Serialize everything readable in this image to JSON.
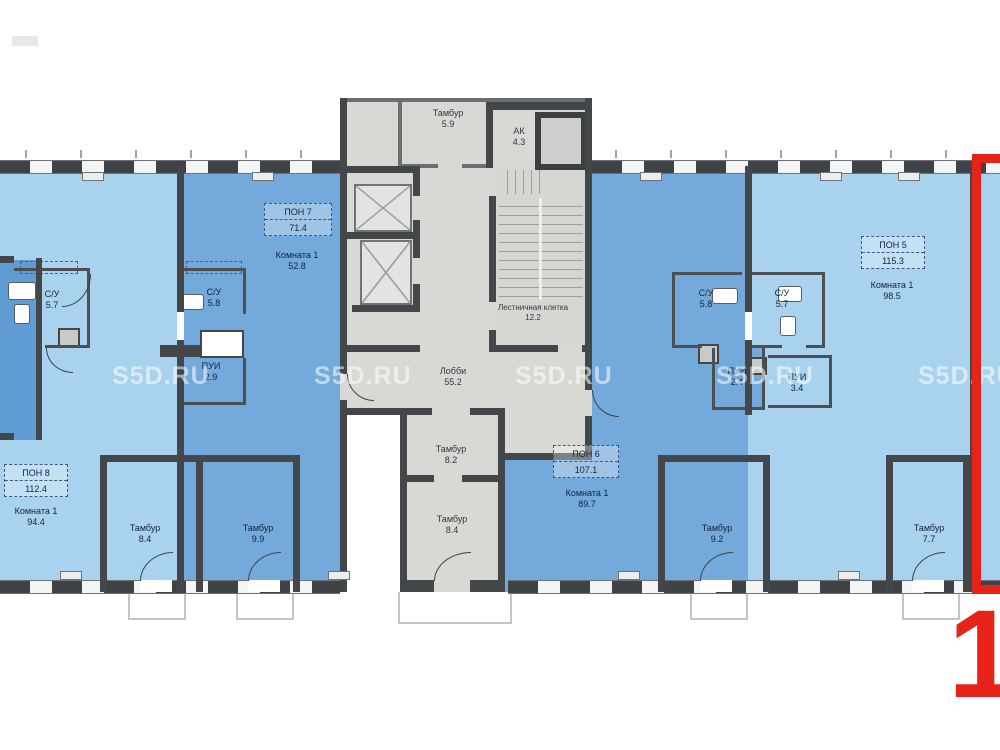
{
  "watermark": {
    "text": "S5D.RU"
  },
  "highlight": {
    "label": "1",
    "color": "#e62219"
  },
  "colors": {
    "room_light_blue": "#a9d2ee",
    "room_dark_blue": "#74a9db",
    "common_grey": "#d8d8d5",
    "wall": "#43474a",
    "highlight_red": "#e62219"
  },
  "units": {
    "pon8": {
      "name": "ПОН 8",
      "area": "112.4",
      "room_name": "Комната 1",
      "room_area": "94.4"
    },
    "pon7": {
      "name": "ПОН 7",
      "area": "71.4",
      "room_name": "Комната 1",
      "room_area": "52.8"
    },
    "pon6": {
      "name": "ПОН 6",
      "area": "107.1",
      "room_name": "Комната 1",
      "room_area": "89.7"
    },
    "pon5": {
      "name": "ПОН 5",
      "area": "115.3",
      "room_name": "Комната 1",
      "room_area": "98.5"
    }
  },
  "rooms": {
    "tambur_top": {
      "name": "Тамбур",
      "area": "5.9"
    },
    "ak": {
      "name": "АК",
      "area": "4.3"
    },
    "stair": {
      "name": "Лестничная клетка",
      "area": "12.2"
    },
    "lobby": {
      "name": "Лобби",
      "area": "55.2"
    },
    "tambur_82": {
      "name": "Тамбур",
      "area": "8.2"
    },
    "tambur_84c": {
      "name": "Тамбур",
      "area": "8.4"
    },
    "su57_left": {
      "name": "С/У",
      "area": "5.7"
    },
    "su58_left": {
      "name": "С/У",
      "area": "5.8"
    },
    "pui29": {
      "name": "ПУИ",
      "area": "2.9"
    },
    "tambur_84l": {
      "name": "Тамбур",
      "area": "8.4"
    },
    "tambur_99": {
      "name": "Тамбур",
      "area": "9.9"
    },
    "su58_right": {
      "name": "С/У",
      "area": "5.8"
    },
    "su57_right": {
      "name": "С/У",
      "area": "5.7"
    },
    "pui24": {
      "name": "ПУИ",
      "area": "2.4"
    },
    "pui34": {
      "name": "ПУИ",
      "area": "3.4"
    },
    "tambur_92": {
      "name": "Тамбур",
      "area": "9.2"
    },
    "tambur_77": {
      "name": "Тамбур",
      "area": "7.7"
    }
  }
}
